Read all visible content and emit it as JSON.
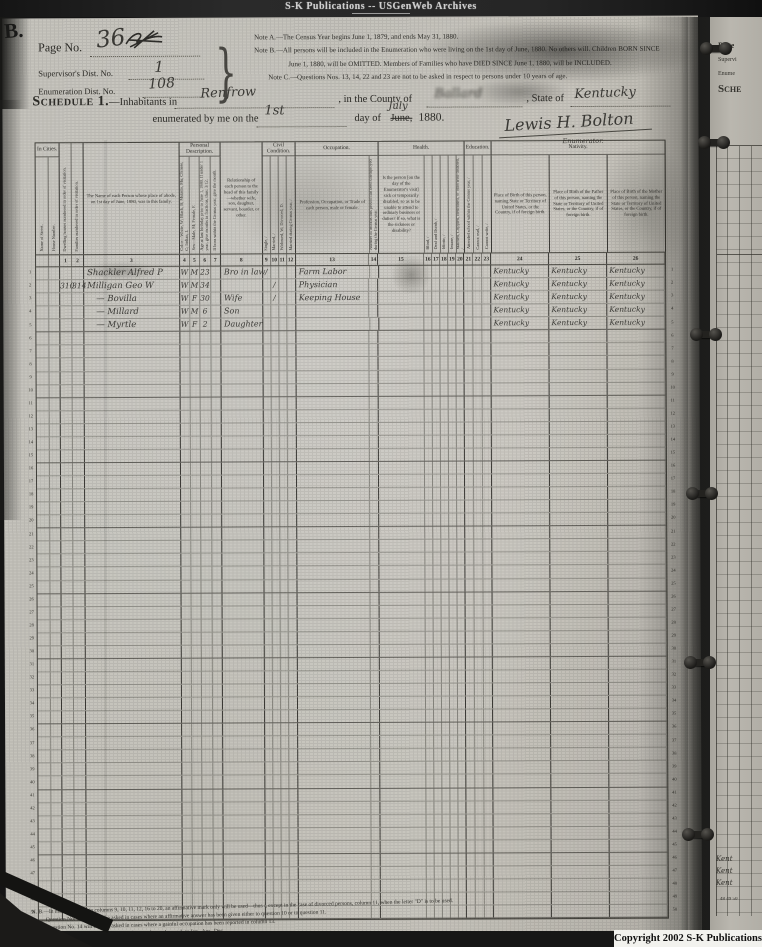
{
  "banner": {
    "text": "S-K Publications -- USGenWeb Archives"
  },
  "copyright": {
    "text": "Copyright 2002 S-K Publications"
  },
  "corner_mark": "B.",
  "header": {
    "page_no_label": "Page No.",
    "page_no_value": "36",
    "supervisor_label": "Supervisor's Dist. No.",
    "supervisor_value": "1",
    "enumeration_label": "Enumeration Dist. No.",
    "enumeration_value": "108",
    "note_a": "Note A.—The Census Year begins June 1, 1879, and ends May 31, 1880.",
    "note_b1": "Note B.—All persons will be included in the Enumeration who were living on the 1st day of June, 1880.  No others will.  Children BORN SINCE",
    "note_b2": "June 1, 1880, will be OMITTED.  Members of Families who have DIED SINCE June 1, 1880, will be INCLUDED.",
    "note_c": "Note C.—Questions Nos. 13, 14, 22 and 23 are not to be asked in respect to persons under 10 years of age.",
    "schedule_label": "Schedule 1.",
    "inhabitants_label": "—Inhabitants in",
    "place_value": "Renfrow",
    "county_label": ", in the County of",
    "county_value": "Ballard",
    "state_label": ", State of",
    "state_value": "Kentucky",
    "enumerated_label": "enumerated by me on the",
    "day_value": "1st",
    "day_of_label": "day of",
    "month_printed": "June,",
    "month_written": "July",
    "year_value": "1880.",
    "signature": "Lewis H. Bolton",
    "enumerator_label": "Enumerator."
  },
  "table": {
    "groups": {
      "in_cities": "In Cities.",
      "personal": "Personal Description.",
      "civil": "Civil Condition.",
      "occupation": "Occupation.",
      "health": "Health.",
      "education": "Education.",
      "nativity": "Nativity."
    },
    "headers": {
      "street": "Name of Street.",
      "house": "House Number.",
      "dwelling": "Dwelling houses numbered in order of visitation.",
      "family": "Families numbered in order of visitation.",
      "name": "The Name of each Person whose place of abode, on 1st day of June, 1880, was in this family.",
      "color": "Color—White, W; Black, B; Mulatto, Mu; Chinese, C; Indian, I.",
      "sex": "Sex—Male, M; Female, F.",
      "age": "Age at last birthday prior to June 1, 1880. If under 1 year, give months in fractions, thus: 3/12.",
      "month": "If born within the Census year, give the month.",
      "relationship": "Relationship of each person to the head of this family—whether wife, son, daughter, servant, boarder, or other.",
      "single": "Single, /",
      "married": "Married, /",
      "widowed": "Widowed, W; Divorced, D.",
      "married_cy": "Married during Census year, /",
      "occupation": "Profession, Occupation, or Trade of each person, male or female.",
      "months_unemp": "Number of months this person has been unemployed during the Census year.",
      "sickness": "Is the person [on the day of the Enumerator's visit] sick or temporarily disabled, so as to be unable to attend to ordinary business or duties?  If so, what is the sickness or disability?",
      "blind": "Blind, /",
      "deaf": "Deaf and Dumb, /",
      "idiotic": "Idiotic, /",
      "insane": "Insane, /",
      "maimed": "Maimed, Crippled, Bedridden, or otherwise disabled, /",
      "school": "Attended school within the Census year, /",
      "cannot_read": "Cannot read, /",
      "cannot_write": "Cannot write, /",
      "birth_self": "Place of Birth of this person, naming State or Territory of United States, or the Country, if of foreign birth.",
      "birth_father": "Place of Birth of the Father of this person, naming the State or Territory of United States, or the Country, if of foreign birth.",
      "birth_mother": "Place of Birth of the Mother of this person, naming the State or Territory of United States, or the Country, if of foreign birth."
    },
    "column_numbers": [
      "1",
      "2",
      "3",
      "4",
      "5",
      "6",
      "7",
      "8",
      "9",
      "10",
      "11",
      "12",
      "13",
      "14",
      "15",
      "16",
      "17",
      "18",
      "19",
      "20",
      "21",
      "22",
      "23",
      "24",
      "25",
      "26"
    ],
    "line_count": 50,
    "entries": [
      {
        "line": 1,
        "name": "Shackler Alfred P",
        "color": "W",
        "sex": "M",
        "age": "23",
        "relationship": "Bro in law",
        "single": "/",
        "occupation": "Farm Labor",
        "birth_self": "Kentucky",
        "birth_father": "Kentucky",
        "birth_mother": "Kentucky"
      },
      {
        "line": 2,
        "dwelling": "310",
        "family": "314",
        "name": "Milligan Geo W",
        "color": "W",
        "sex": "M",
        "age": "34",
        "married": "/",
        "occupation": "Physician",
        "birth_self": "Kentucky",
        "birth_father": "Kentucky",
        "birth_mother": "Kentucky"
      },
      {
        "line": 3,
        "name": "— Bovilla",
        "color": "W",
        "sex": "F",
        "age": "30",
        "relationship": "Wife",
        "married": "/",
        "occupation": "Keeping House",
        "birth_self": "Kentucky",
        "birth_father": "Kentucky",
        "birth_mother": "Kentucky"
      },
      {
        "line": 4,
        "name": "— Millard",
        "color": "W",
        "sex": "M",
        "age": "6",
        "relationship": "Son",
        "birth_self": "Kentucky",
        "birth_father": "Kentucky",
        "birth_mother": "Kentucky"
      },
      {
        "line": 5,
        "name": "— Myrtle",
        "color": "W",
        "sex": "F",
        "age": "2",
        "relationship": "Daughter",
        "birth_self": "Kentucky",
        "birth_father": "Kentucky",
        "birth_mother": "Kentucky"
      }
    ]
  },
  "footnotes": {
    "line1": "N. B.—In making entries in columns 9, 10, 11, 12, 16 to 20, an affirmative mark only will be used—thus /, except in the case of divorced persons, column 11, when the letter \"D\" is to be used.",
    "line2": "Question No. 12 will only be asked in cases where an affirmative answer has been given either to question 10 or to question 11.",
    "line3": "Question No. 14 will only be asked in cases where a gainful occupation has been reported in column 13.",
    "line4": "In column 7 an abbreviation for the name of the month may be used, as Jan., Apr., Dec."
  },
  "side_page": {
    "page_label": "Page",
    "supervisor_label": "Supervi",
    "enumeration_label": "Enume",
    "schedule_label": "Sche",
    "kentucky_fragments": [
      "Kent",
      "Kent",
      "Kent"
    ],
    "bottom_line_numbers": "48 49 50"
  }
}
